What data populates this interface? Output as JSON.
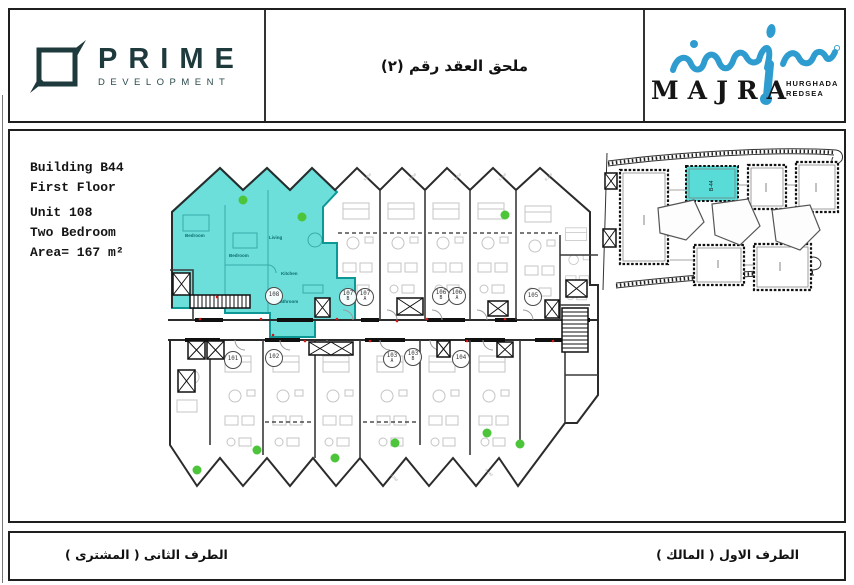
{
  "header": {
    "prime_name": "PRIME",
    "prime_subtitle": "DEVELOPMENT",
    "title_ar": "ملحق العقد رقم (٢)",
    "majra_name": "MAJRA",
    "majra_loc1": "HURGHADA",
    "majra_loc2": "REDSEA"
  },
  "unit_info": {
    "line1": "Building B44",
    "line2": "First Floor",
    "line3": "Unit 108",
    "line4": "Two Bedroom",
    "line5": "Area= 167 m²"
  },
  "plan": {
    "highlight_color": "#58dbd6",
    "accent_green": "#4cc53a",
    "dim_a": "5.050",
    "dim_b": "0.240",
    "dim_c": "0.200",
    "rooms": {
      "bedroom": "Bedroom",
      "bedroom2": "Bedroom",
      "living": "Living",
      "kitchen": "Kitchen",
      "bathroom": "Bathroom"
    },
    "unit_labels": [
      {
        "line1": "108",
        "line2": ""
      },
      {
        "line1": "107",
        "line2": "B"
      },
      {
        "line1": "107",
        "line2": "A"
      },
      {
        "line1": "106",
        "line2": "B"
      },
      {
        "line1": "106",
        "line2": "A"
      },
      {
        "line1": "105",
        "line2": ""
      },
      {
        "line1": "101",
        "line2": ""
      },
      {
        "line1": "102",
        "line2": ""
      },
      {
        "line1": "103",
        "line2": "A"
      },
      {
        "line1": "103",
        "line2": "B"
      },
      {
        "line1": "104",
        "line2": ""
      }
    ]
  },
  "site": {
    "highlight_label": "B-44"
  },
  "footer": {
    "party_second": "الطرف الثانى ( المشترى )",
    "party_first": "الطرف الاول ( المالك )"
  }
}
